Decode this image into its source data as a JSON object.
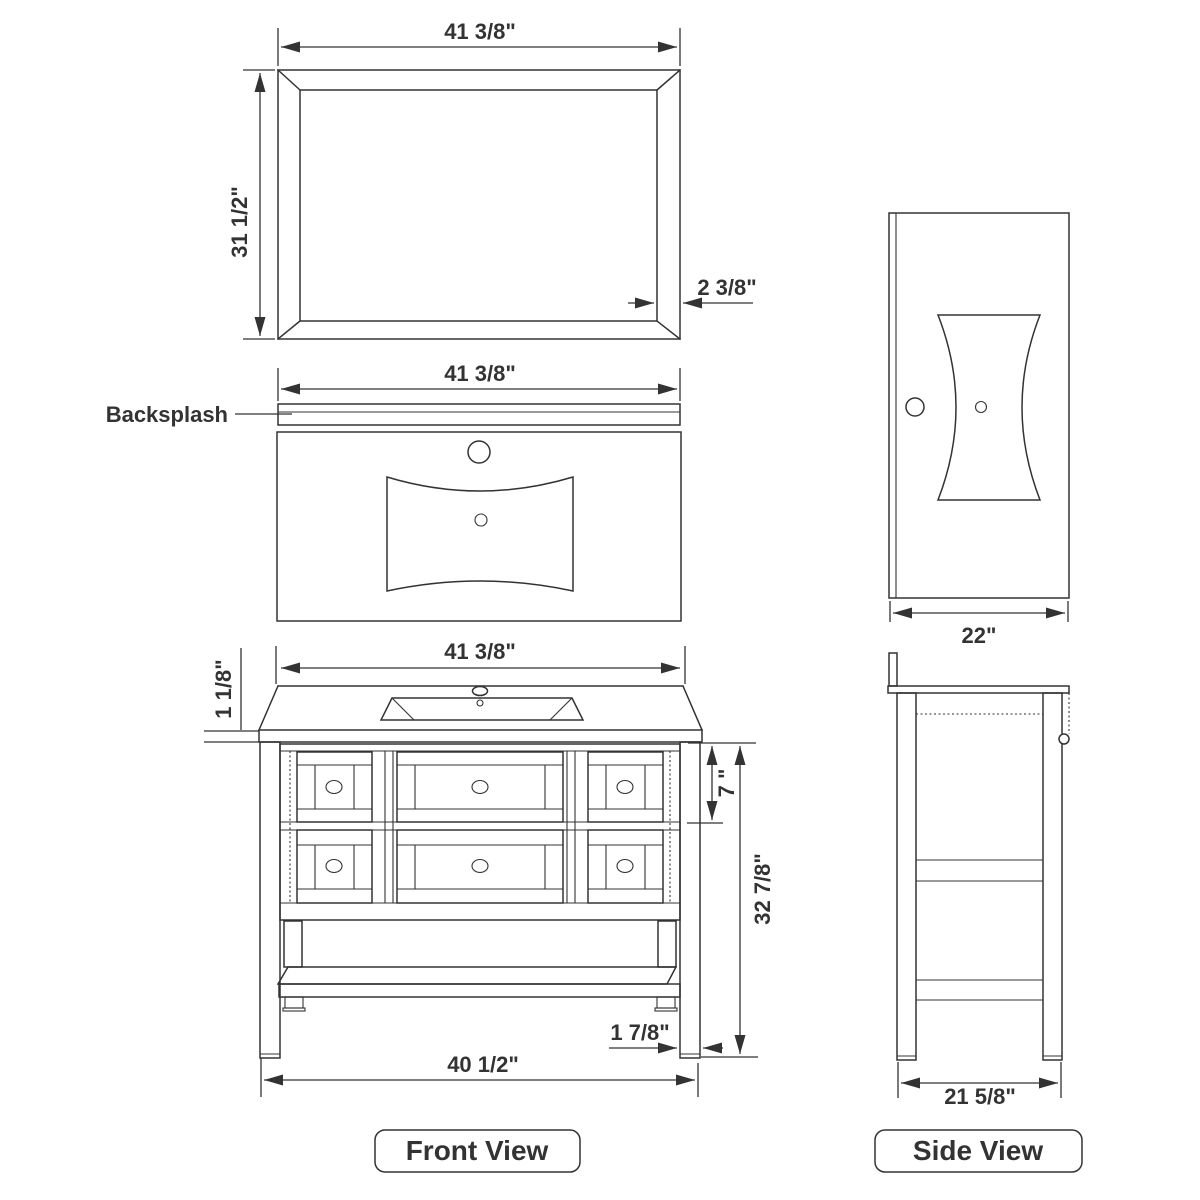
{
  "colors": {
    "line": "#333333",
    "text": "#333333",
    "background": "#ffffff"
  },
  "mirror_view": {
    "width_dim": "41 3/8\"",
    "height_dim": "31 1/2\"",
    "frame_thickness_dim": "2 3/8\""
  },
  "counter_view": {
    "width_dim": "41 3/8\"",
    "backsplash_label": "Backsplash"
  },
  "front_view": {
    "label": "Front View",
    "width_dim": "41 3/8\"",
    "counter_thickness_dim": "1 1/8\"",
    "drawer_height_dim": "7 \"",
    "cabinet_height_dim": "32 7/8\"",
    "leg_width_dim": "1 7/8\"",
    "base_width_dim": "40 1/2\""
  },
  "side_view": {
    "label": "Side View",
    "depth_dim": "22\"",
    "base_depth_dim": "21 5/8\""
  }
}
